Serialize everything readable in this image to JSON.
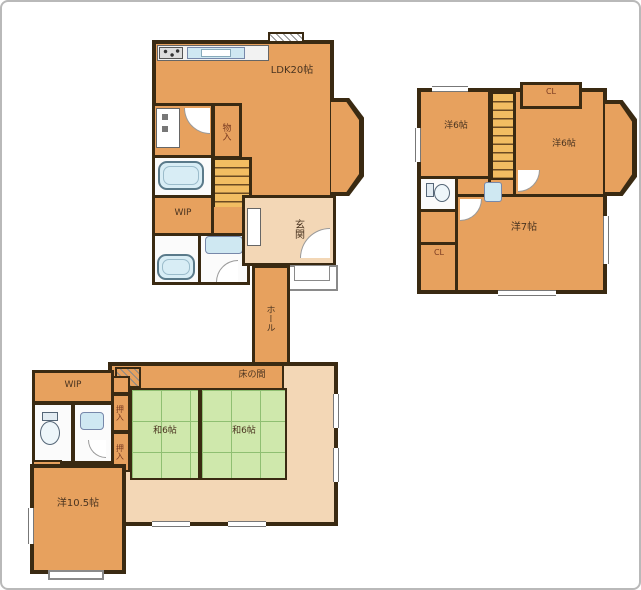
{
  "colors": {
    "room_orange": "#e7a15e",
    "corridor_peach": "#f3d7b6",
    "tatami_green": "#cfe8ac",
    "wall_dark": "#3a2a12",
    "fixture_blue": "#cfe8f2",
    "stair_yellow": "#f2bd62",
    "label_ink": "#4a3420"
  },
  "floor1": {
    "ldk": "LDK20帖",
    "storage_small": "物入",
    "wip_upper": "WIP",
    "entrance": "玄関",
    "hall": "ホール",
    "wip_lower": "WIP",
    "closet_cl": "CL",
    "western_room": "洋10.5帖",
    "tatami_left": "和6帖",
    "tatami_right": "和6帖",
    "tokonoma": "床の間",
    "oshiire_a": "押入",
    "oshiire_b": "押入"
  },
  "floor2": {
    "room_nw": "洋6帖",
    "room_ne": "洋6帖",
    "room_s": "洋7帖",
    "closet_top": "CL",
    "closet_side": "CL"
  }
}
